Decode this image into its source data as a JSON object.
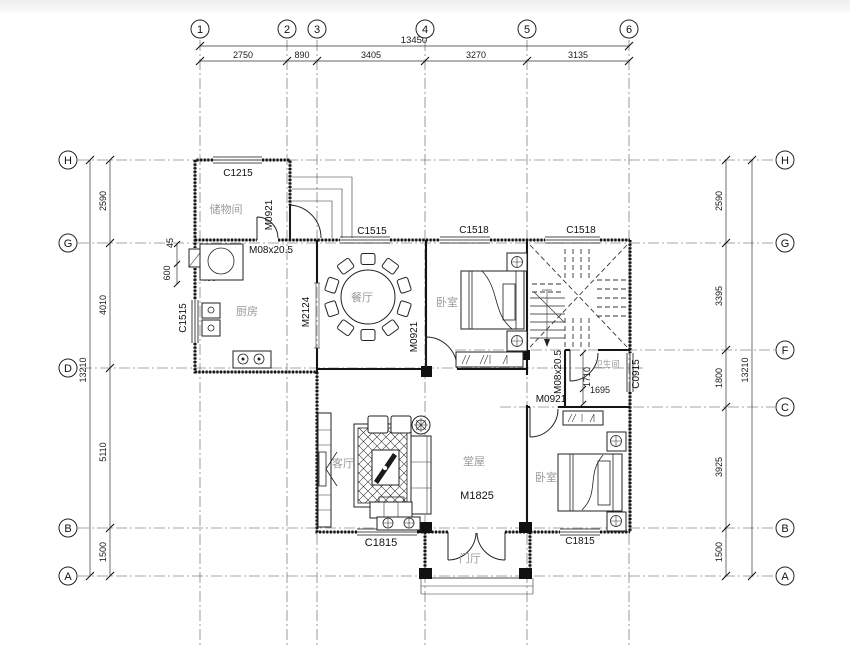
{
  "axes": {
    "top": [
      "1",
      "2",
      "3",
      "4",
      "5",
      "6"
    ],
    "left": [
      "H",
      "G",
      "D",
      "B",
      "A"
    ],
    "right": [
      "H",
      "G",
      "F",
      "C",
      "B",
      "A"
    ]
  },
  "dims": {
    "top_total": "13450",
    "top_segments": [
      "2750",
      "890",
      "3405",
      "3270",
      "3135"
    ],
    "left_total": "13210",
    "left_segments": [
      "2590",
      "4010",
      "5110",
      "1500"
    ],
    "right_total": "13210",
    "right_segments": [
      "2590",
      "3395",
      "1800",
      "3925",
      "1500"
    ],
    "small": {
      "d45": "45",
      "d600": "600",
      "d400": "400",
      "d1710": "1710",
      "d1695": "1695"
    }
  },
  "rooms": {
    "storage": "储物间",
    "kitchen": "厨房",
    "dining": "餐厅",
    "bedroom1": "卧室",
    "bedroom2": "卧室",
    "living": "客厅",
    "hall": "堂屋",
    "foyer": "门厅",
    "bath": "卫生间"
  },
  "openings": {
    "c1215": "C1215",
    "m0921_storage": "M0921",
    "m08_kitchen": "M08x20.5",
    "c1515_left": "C1515",
    "m2124": "M2124",
    "c1515_top": "C1515",
    "c1518_a": "C1518",
    "c1518_b": "C1518",
    "m0921_dining": "M0921",
    "m08_bath": "M08x20.5",
    "m0921_bed2": "M0921",
    "c0915": "C0915",
    "m1825": "M1825",
    "c1815_living": "C1815",
    "c1815_bed2": "C1815"
  }
}
